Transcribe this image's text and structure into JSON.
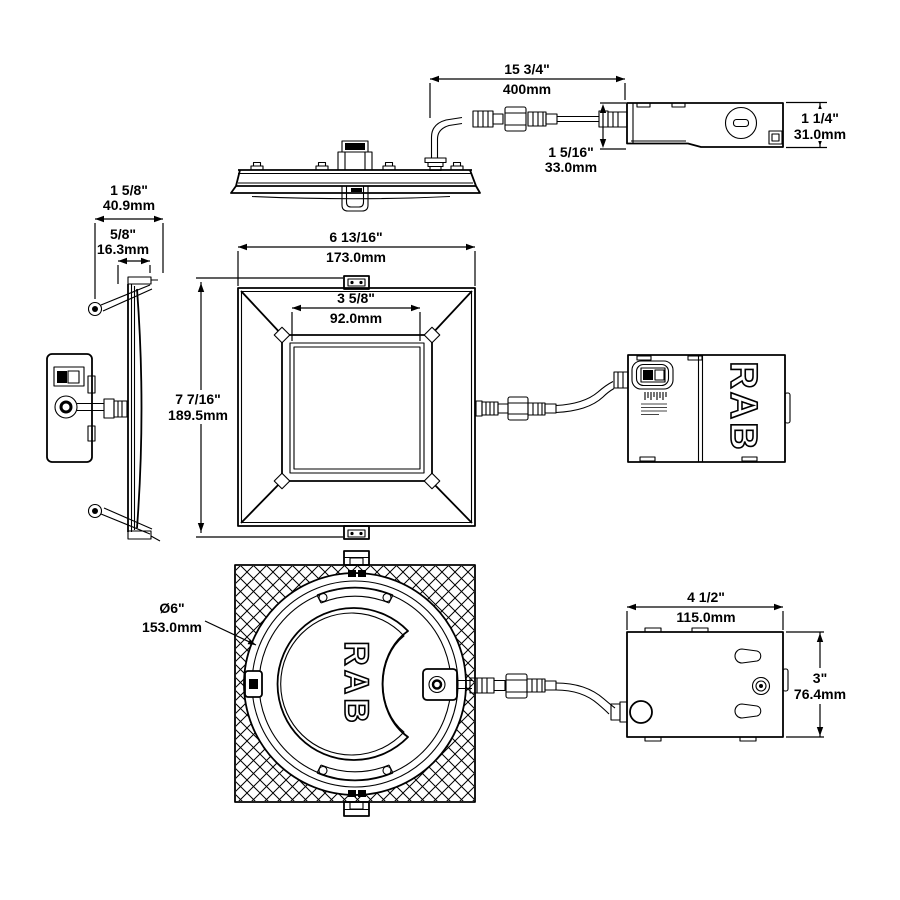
{
  "drawing": {
    "brand": {
      "driver_logo": "RAB",
      "housing_logo": "RAB"
    },
    "dimensions": {
      "clip_spread": {
        "inch": "1 5/8\"",
        "mm": "40.9mm"
      },
      "edge_thickness": {
        "inch": "5/8\"",
        "mm": "16.3mm"
      },
      "whip_length": {
        "inch": "15 3/4\"",
        "mm": "400mm"
      },
      "driver_front_height": {
        "inch": "1 5/16\"",
        "mm": "33.0mm"
      },
      "driver_height": {
        "inch": "1 1/4\"",
        "mm": "31.0mm"
      },
      "face_width": {
        "inch": "6 13/16\"",
        "mm": "173.0mm"
      },
      "aperture_width": {
        "inch": "3 5/8\"",
        "mm": "92.0mm"
      },
      "face_height": {
        "inch": "7 7/16\"",
        "mm": "189.5mm"
      },
      "housing_diameter": {
        "inch": "Ø6\"",
        "mm": "153.0mm"
      },
      "jbox_width": {
        "inch": "4 1/2\"",
        "mm": "115.0mm"
      },
      "jbox_height": {
        "inch": "3\"",
        "mm": "76.4mm"
      }
    },
    "colors": {
      "line": "#000000",
      "background": "#ffffff"
    }
  }
}
